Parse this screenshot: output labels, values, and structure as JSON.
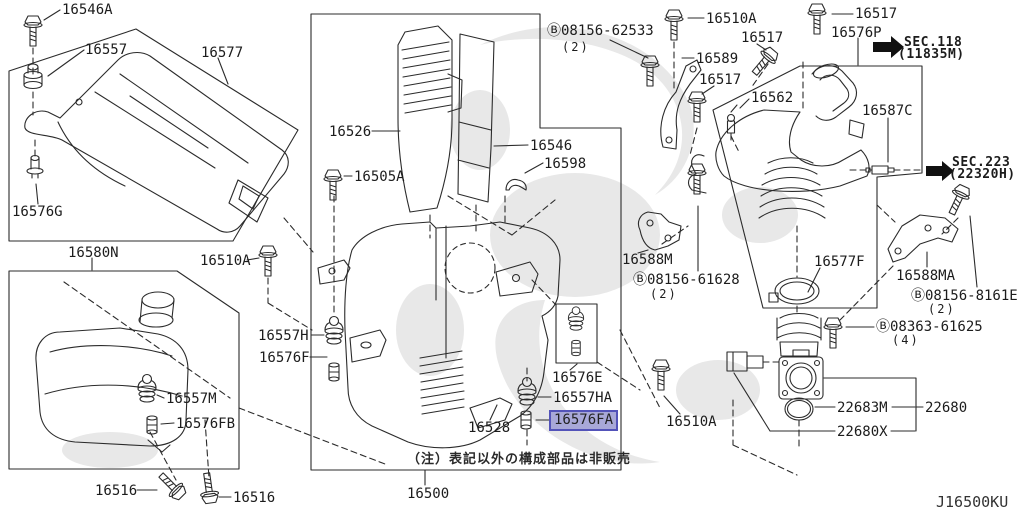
{
  "theme": {
    "highlight_bg": "#a8a8d8",
    "highlight_border": "#5353b9",
    "line_color": "#2b2b2b",
    "watermark_color": "#e8e8e8"
  },
  "note": "（注）表記以外の構成部品は非販売",
  "diagram_code": "J16500KU",
  "sec_refs": [
    {
      "label": "SEC.118",
      "sub": "(11835M)"
    },
    {
      "label": "SEC.223",
      "sub": "(22320H)"
    }
  ],
  "labels": [
    {
      "n": "part-label-16546A",
      "t": "16546A",
      "x": 62,
      "y": 3,
      "c": "",
      "i": true
    },
    {
      "n": "part-label-16557",
      "t": "16557",
      "x": 85,
      "y": 43,
      "c": "",
      "i": true
    },
    {
      "n": "part-label-16577",
      "t": "16577",
      "x": 201,
      "y": 46,
      "c": "",
      "i": true
    },
    {
      "n": "part-label-16576G",
      "t": "16576G",
      "x": 12,
      "y": 205,
      "c": "",
      "i": true
    },
    {
      "n": "part-label-16580N",
      "t": "16580N",
      "x": 68,
      "y": 246,
      "c": "",
      "i": true
    },
    {
      "n": "part-label-16510A-1",
      "t": "16510A",
      "x": 200,
      "y": 254,
      "c": "",
      "i": true
    },
    {
      "n": "part-label-16557M",
      "t": "16557M",
      "x": 166,
      "y": 392,
      "c": "",
      "i": true
    },
    {
      "n": "part-label-16576FB",
      "t": "16576FB",
      "x": 176,
      "y": 417,
      "c": "",
      "i": true
    },
    {
      "n": "part-label-16516-1",
      "t": "16516",
      "x": 95,
      "y": 484,
      "c": "",
      "i": true
    },
    {
      "n": "part-label-16516-2",
      "t": "16516",
      "x": 233,
      "y": 491,
      "c": "",
      "i": true
    },
    {
      "n": "part-label-16526",
      "t": "16526",
      "x": 329,
      "y": 125,
      "c": "",
      "i": true
    },
    {
      "n": "part-label-16505A",
      "t": "16505A",
      "x": 354,
      "y": 170,
      "c": "",
      "i": true
    },
    {
      "n": "part-label-16546",
      "t": "16546",
      "x": 530,
      "y": 139,
      "c": "",
      "i": true
    },
    {
      "n": "part-label-16598",
      "t": "16598",
      "x": 544,
      "y": 157,
      "c": "",
      "i": true
    },
    {
      "n": "part-label-16557H",
      "t": "16557H",
      "x": 258,
      "y": 329,
      "c": "",
      "i": true
    },
    {
      "n": "part-label-16576F",
      "t": "16576F",
      "x": 259,
      "y": 351,
      "c": "",
      "i": true
    },
    {
      "n": "part-label-16528",
      "t": "16528",
      "x": 468,
      "y": 421,
      "c": "",
      "i": true
    },
    {
      "n": "part-label-16576E",
      "t": "16576E",
      "x": 552,
      "y": 371,
      "c": "",
      "i": true
    },
    {
      "n": "part-label-16557HA",
      "t": "16557HA",
      "x": 553,
      "y": 391,
      "c": "",
      "i": true
    },
    {
      "n": "part-label-16576FA",
      "t": "16576FA",
      "x": 554,
      "y": 413,
      "c": "hl",
      "i": true
    },
    {
      "n": "part-label-16510A-3",
      "t": "16510A",
      "x": 666,
      "y": 415,
      "c": "",
      "i": true
    },
    {
      "n": "part-label-16500",
      "t": "16500",
      "x": 407,
      "y": 487,
      "c": "",
      "i": true
    },
    {
      "n": "note-jp",
      "t": "（注）表記以外の構成部品は非販売",
      "x": 407,
      "y": 452,
      "c": "note",
      "i": false
    },
    {
      "n": "part-label-08156-62533",
      "t": "Ⓑ08156-62533",
      "x": 547,
      "y": 24,
      "c": "",
      "i": true
    },
    {
      "n": "qty-08156-62533",
      "t": "(2)",
      "x": 562,
      "y": 40,
      "c": "qty",
      "i": false
    },
    {
      "n": "part-label-16510A-2",
      "t": "16510A",
      "x": 706,
      "y": 12,
      "c": "",
      "i": true
    },
    {
      "n": "part-label-16589",
      "t": "16589",
      "x": 696,
      "y": 52,
      "c": "",
      "i": true
    },
    {
      "n": "part-label-16517-1",
      "t": "16517",
      "x": 741,
      "y": 31,
      "c": "",
      "i": true
    },
    {
      "n": "part-label-16517-2",
      "t": "16517",
      "x": 699,
      "y": 73,
      "c": "",
      "i": true
    },
    {
      "n": "part-label-16562",
      "t": "16562",
      "x": 751,
      "y": 91,
      "c": "",
      "i": true
    },
    {
      "n": "part-label-16517-3",
      "t": "16517",
      "x": 855,
      "y": 7,
      "c": "",
      "i": true
    },
    {
      "n": "part-label-16576P",
      "t": "16576P",
      "x": 831,
      "y": 26,
      "c": "",
      "i": true
    },
    {
      "n": "sec-ref-118",
      "t": "SEC.118",
      "x": 904,
      "y": 35,
      "c": "sec",
      "i": false
    },
    {
      "n": "sec-ref-118-sub",
      "t": "(11835M)",
      "x": 898,
      "y": 47,
      "c": "sec",
      "i": false
    },
    {
      "n": "part-label-16587C",
      "t": "16587C",
      "x": 862,
      "y": 104,
      "c": "",
      "i": true
    },
    {
      "n": "sec-ref-223",
      "t": "SEC.223",
      "x": 952,
      "y": 155,
      "c": "sec",
      "i": false
    },
    {
      "n": "sec-ref-223-sub",
      "t": "(22320H)",
      "x": 949,
      "y": 167,
      "c": "sec",
      "i": false
    },
    {
      "n": "part-label-16588M",
      "t": "16588M",
      "x": 622,
      "y": 253,
      "c": "",
      "i": true
    },
    {
      "n": "part-label-08156-61628",
      "t": "Ⓑ08156-61628",
      "x": 633,
      "y": 273,
      "c": "",
      "i": true
    },
    {
      "n": "qty-08156-61628",
      "t": "(2)",
      "x": 650,
      "y": 287,
      "c": "qty",
      "i": false
    },
    {
      "n": "part-label-16577F",
      "t": "16577F",
      "x": 814,
      "y": 255,
      "c": "",
      "i": true
    },
    {
      "n": "part-label-16588MA",
      "t": "16588MA",
      "x": 896,
      "y": 269,
      "c": "",
      "i": true
    },
    {
      "n": "part-label-08156-8161E",
      "t": "Ⓑ08156-8161E",
      "x": 911,
      "y": 289,
      "c": "",
      "i": true
    },
    {
      "n": "qty-08156-8161E",
      "t": "(2)",
      "x": 928,
      "y": 302,
      "c": "qty",
      "i": false
    },
    {
      "n": "part-label-08363-61625",
      "t": "Ⓑ08363-61625",
      "x": 876,
      "y": 320,
      "c": "",
      "i": true
    },
    {
      "n": "qty-08363-61625",
      "t": "(4)",
      "x": 892,
      "y": 333,
      "c": "qty",
      "i": false
    },
    {
      "n": "part-label-22683M",
      "t": "22683M",
      "x": 837,
      "y": 401,
      "c": "",
      "i": true
    },
    {
      "n": "part-label-22680",
      "t": "22680",
      "x": 925,
      "y": 401,
      "c": "",
      "i": true
    },
    {
      "n": "part-label-22680X",
      "t": "22680X",
      "x": 837,
      "y": 425,
      "c": "",
      "i": true
    },
    {
      "n": "diagram-code",
      "t": "J16500KU",
      "x": 936,
      "y": 495,
      "c": "code",
      "i": false
    }
  ]
}
